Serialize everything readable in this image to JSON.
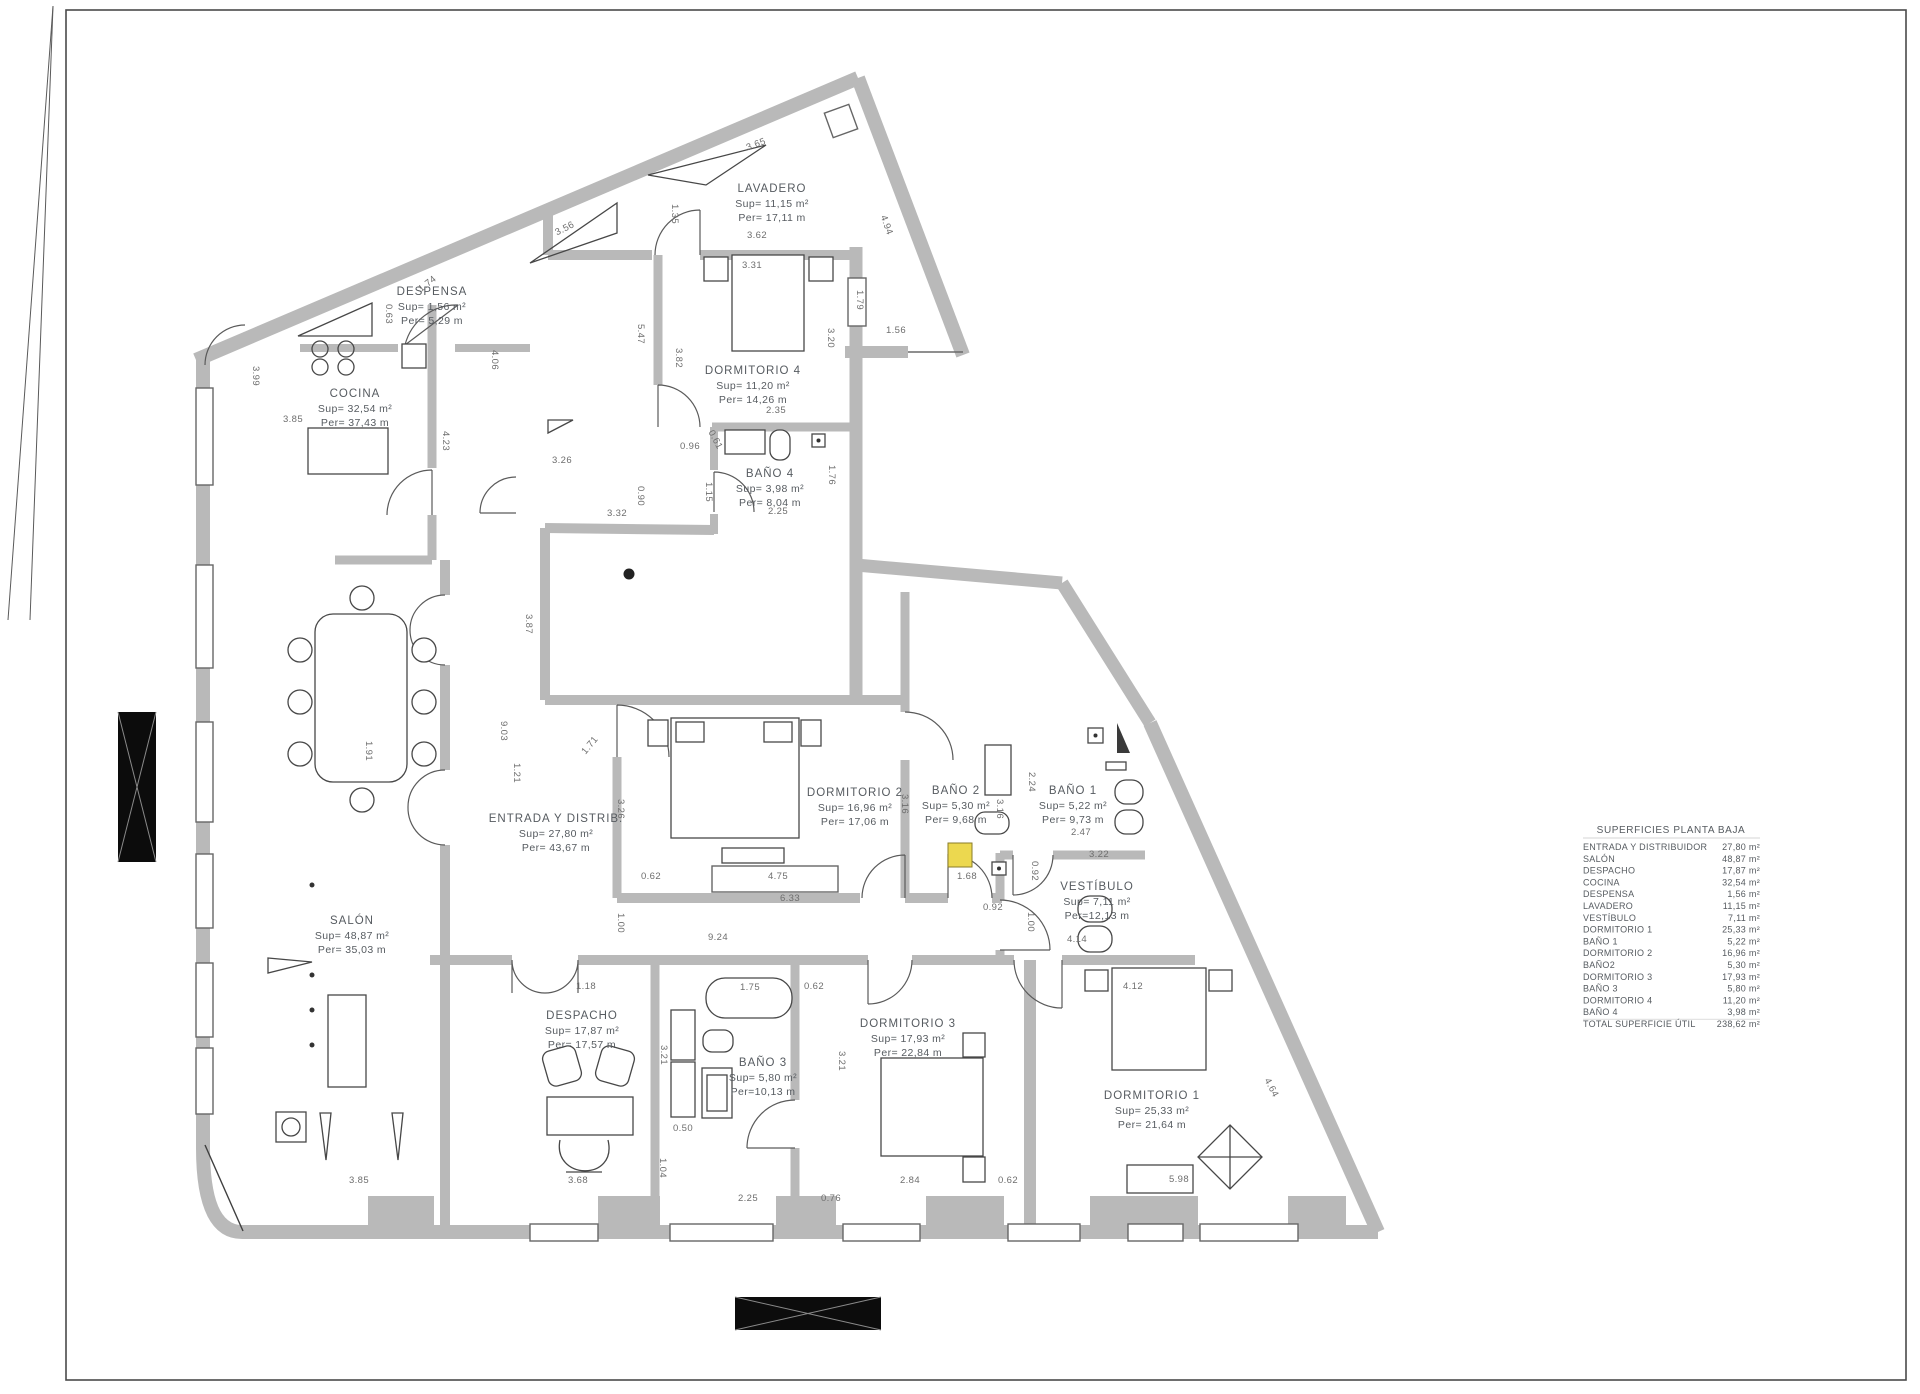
{
  "legend": {
    "title": "SUPERFICIES PLANTA BAJA",
    "rows": [
      {
        "name": "ENTRADA Y DISTRIBUIDOR",
        "value": "27,80 m²"
      },
      {
        "name": "SALÓN",
        "value": "48,87 m²"
      },
      {
        "name": "DESPACHO",
        "value": "17,87 m²"
      },
      {
        "name": "COCINA",
        "value": "32,54 m²"
      },
      {
        "name": "DESPENSA",
        "value": "1,56 m²"
      },
      {
        "name": "LAVADERO",
        "value": "11,15 m²"
      },
      {
        "name": "VESTÍBULO",
        "value": "7,11 m²"
      },
      {
        "name": "DORMITORIO 1",
        "value": "25,33 m²"
      },
      {
        "name": "BAÑO 1",
        "value": "5,22 m²"
      },
      {
        "name": "DORMITORIO 2",
        "value": "16,96 m²"
      },
      {
        "name": "BAÑO2",
        "value": "5,30 m²"
      },
      {
        "name": "DORMITORIO 3",
        "value": "17,93 m²"
      },
      {
        "name": "BAÑO 3",
        "value": "5,80 m²"
      },
      {
        "name": "DORMITORIO 4",
        "value": "11,20 m²"
      },
      {
        "name": "BAÑO 4",
        "value": "3,98 m²"
      },
      {
        "name": "TOTAL SUPERFICIE ÚTIL",
        "value": "238,62 m²"
      }
    ]
  },
  "rooms": [
    {
      "id": "lavadero",
      "name": "LAVADERO",
      "sup": "Sup= 11,15 m²",
      "per": "Per= 17,11 m",
      "x": 772,
      "y": 192
    },
    {
      "id": "despensa",
      "name": "DESPENSA",
      "sup": "Sup= 1,56 m²",
      "per": "Per= 5,29 m",
      "x": 432,
      "y": 295
    },
    {
      "id": "cocina",
      "name": "COCINA",
      "sup": "Sup= 32,54 m²",
      "per": "Per= 37,43 m",
      "x": 355,
      "y": 397
    },
    {
      "id": "dormitorio4",
      "name": "DORMITORIO 4",
      "sup": "Sup= 11,20 m²",
      "per": "Per= 14,26 m",
      "x": 753,
      "y": 374
    },
    {
      "id": "bano4",
      "name": "BAÑO 4",
      "sup": "Sup= 3,98 m²",
      "per": "Per= 8,04 m",
      "x": 770,
      "y": 477
    },
    {
      "id": "entrada",
      "name": "ENTRADA Y DISTRIB.",
      "sup": "Sup= 27,80 m²",
      "per": "Per= 43,67 m",
      "x": 556,
      "y": 822
    },
    {
      "id": "dormitorio2",
      "name": "DORMITORIO 2",
      "sup": "Sup= 16,96 m²",
      "per": "Per= 17,06 m",
      "x": 855,
      "y": 796
    },
    {
      "id": "bano2",
      "name": "BAÑO 2",
      "sup": "Sup= 5,30 m²",
      "per": "Per= 9,68 m",
      "x": 956,
      "y": 794
    },
    {
      "id": "bano1",
      "name": "BAÑO 1",
      "sup": "Sup= 5,22 m²",
      "per": "Per= 9,73 m",
      "x": 1073,
      "y": 794
    },
    {
      "id": "vestibulo",
      "name": "VESTÍBULO",
      "sup": "Sup=  7,11 m²",
      "per": "Per=12,13 m",
      "x": 1097,
      "y": 890
    },
    {
      "id": "salon",
      "name": "SALÓN",
      "sup": "Sup= 48,87 m²",
      "per": "Per= 35,03 m",
      "x": 352,
      "y": 924
    },
    {
      "id": "despacho",
      "name": "DESPACHO",
      "sup": "Sup= 17,87 m²",
      "per": "Per= 17,57 m",
      "x": 582,
      "y": 1019
    },
    {
      "id": "bano3",
      "name": "BAÑO 3",
      "sup": "Sup=  5,80 m²",
      "per": "Per=10,13 m",
      "x": 763,
      "y": 1066
    },
    {
      "id": "dormitorio3",
      "name": "DORMITORIO 3",
      "sup": "Sup= 17,93 m²",
      "per": "Per= 22,84 m",
      "x": 908,
      "y": 1027
    },
    {
      "id": "dormitorio1",
      "name": "DORMITORIO 1",
      "sup": "Sup= 25,33 m²",
      "per": "Per= 21,64 m",
      "x": 1152,
      "y": 1099
    }
  ],
  "dims": [
    {
      "t": "3.65",
      "x": 757,
      "y": 147,
      "r": -21
    },
    {
      "t": "3.62",
      "x": 757,
      "y": 238,
      "r": 0
    },
    {
      "t": "3.31",
      "x": 752,
      "y": 268,
      "r": 0
    },
    {
      "t": "4.94",
      "x": 884,
      "y": 226,
      "r": 70
    },
    {
      "t": "1.35",
      "x": 672,
      "y": 214,
      "r": 90
    },
    {
      "t": "5.47",
      "x": 638,
      "y": 334,
      "r": 90
    },
    {
      "t": "3.82",
      "x": 676,
      "y": 358,
      "r": 90
    },
    {
      "t": "3.20",
      "x": 828,
      "y": 338,
      "r": 90
    },
    {
      "t": "1.56",
      "x": 896,
      "y": 333,
      "r": 0
    },
    {
      "t": "1.79",
      "x": 857,
      "y": 300,
      "r": 90
    },
    {
      "t": "2.35",
      "x": 776,
      "y": 413,
      "r": 0
    },
    {
      "t": "0.96",
      "x": 690,
      "y": 449,
      "r": 0
    },
    {
      "t": "0.61",
      "x": 713,
      "y": 441,
      "r": 62
    },
    {
      "t": "1.15",
      "x": 706,
      "y": 492,
      "r": 90
    },
    {
      "t": "1.76",
      "x": 829,
      "y": 475,
      "r": 90
    },
    {
      "t": "2.25",
      "x": 778,
      "y": 514,
      "r": 0
    },
    {
      "t": "3.56",
      "x": 566,
      "y": 231,
      "r": -27
    },
    {
      "t": "1.74",
      "x": 429,
      "y": 286,
      "r": -38
    },
    {
      "t": "0.63",
      "x": 386,
      "y": 314,
      "r": 90
    },
    {
      "t": "4.06",
      "x": 492,
      "y": 360,
      "r": 90
    },
    {
      "t": "3.99",
      "x": 253,
      "y": 376,
      "r": 90
    },
    {
      "t": "3.85",
      "x": 293,
      "y": 422,
      "r": 0
    },
    {
      "t": "4.23",
      "x": 443,
      "y": 441,
      "r": 90
    },
    {
      "t": "3.26",
      "x": 562,
      "y": 463,
      "r": 0
    },
    {
      "t": "0.90",
      "x": 638,
      "y": 496,
      "r": 90
    },
    {
      "t": "3.32",
      "x": 617,
      "y": 516,
      "r": 0
    },
    {
      "t": "3.87",
      "x": 526,
      "y": 624,
      "r": 90
    },
    {
      "t": "9.03",
      "x": 501,
      "y": 731,
      "r": 90
    },
    {
      "t": "1.21",
      "x": 514,
      "y": 773,
      "r": 90
    },
    {
      "t": "1.71",
      "x": 592,
      "y": 747,
      "r": -50
    },
    {
      "t": "3.26",
      "x": 618,
      "y": 809,
      "r": 90
    },
    {
      "t": "0.62",
      "x": 651,
      "y": 879,
      "r": 0
    },
    {
      "t": "4.75",
      "x": 778,
      "y": 879,
      "r": 0
    },
    {
      "t": "1.00",
      "x": 618,
      "y": 923,
      "r": 90
    },
    {
      "t": "9.24",
      "x": 718,
      "y": 940,
      "r": 0
    },
    {
      "t": "6.33",
      "x": 790,
      "y": 901,
      "r": 0
    },
    {
      "t": "3.16",
      "x": 902,
      "y": 804,
      "r": 90
    },
    {
      "t": "3.16",
      "x": 997,
      "y": 809,
      "r": 90
    },
    {
      "t": "2.24",
      "x": 1029,
      "y": 782,
      "r": 90
    },
    {
      "t": "1.68",
      "x": 967,
      "y": 879,
      "r": 0
    },
    {
      "t": "0.92",
      "x": 1032,
      "y": 871,
      "r": 90
    },
    {
      "t": "0.92",
      "x": 993,
      "y": 910,
      "r": 0
    },
    {
      "t": "1.00",
      "x": 1028,
      "y": 922,
      "r": 90
    },
    {
      "t": "2.47",
      "x": 1081,
      "y": 835,
      "r": 0
    },
    {
      "t": "3.22",
      "x": 1099,
      "y": 857,
      "r": 0
    },
    {
      "t": "4.14",
      "x": 1077,
      "y": 942,
      "r": 0
    },
    {
      "t": "1.18",
      "x": 586,
      "y": 989,
      "r": 0
    },
    {
      "t": "1.75",
      "x": 750,
      "y": 990,
      "r": 0
    },
    {
      "t": "0.62",
      "x": 814,
      "y": 989,
      "r": 0
    },
    {
      "t": "3.21",
      "x": 661,
      "y": 1055,
      "r": 90
    },
    {
      "t": "3.21",
      "x": 839,
      "y": 1061,
      "r": 90
    },
    {
      "t": "0.50",
      "x": 683,
      "y": 1131,
      "r": 0
    },
    {
      "t": "1.04",
      "x": 660,
      "y": 1168,
      "r": 90
    },
    {
      "t": "2.84",
      "x": 910,
      "y": 1183,
      "r": 0
    },
    {
      "t": "0.62",
      "x": 1008,
      "y": 1183,
      "r": 0
    },
    {
      "t": "4.12",
      "x": 1133,
      "y": 989,
      "r": 0
    },
    {
      "t": "4.64",
      "x": 1269,
      "y": 1089,
      "r": 62
    },
    {
      "t": "5.98",
      "x": 1179,
      "y": 1182,
      "r": 0
    },
    {
      "t": "1.91",
      "x": 366,
      "y": 751,
      "r": 90
    },
    {
      "t": "3.85",
      "x": 359,
      "y": 1183,
      "r": 0
    },
    {
      "t": "3.68",
      "x": 578,
      "y": 1183,
      "r": 0
    },
    {
      "t": "2.25",
      "x": 748,
      "y": 1201,
      "r": 0
    },
    {
      "t": "0.76",
      "x": 831,
      "y": 1201,
      "r": 0
    }
  ],
  "colors": {
    "wall": "#b9b9b9",
    "line": "#474747",
    "door": "#5a5a5a",
    "label": "#565b60",
    "dim": "#6e6e6e",
    "highlight": "#ecd84f",
    "black_marker": "#0c0c0c"
  }
}
